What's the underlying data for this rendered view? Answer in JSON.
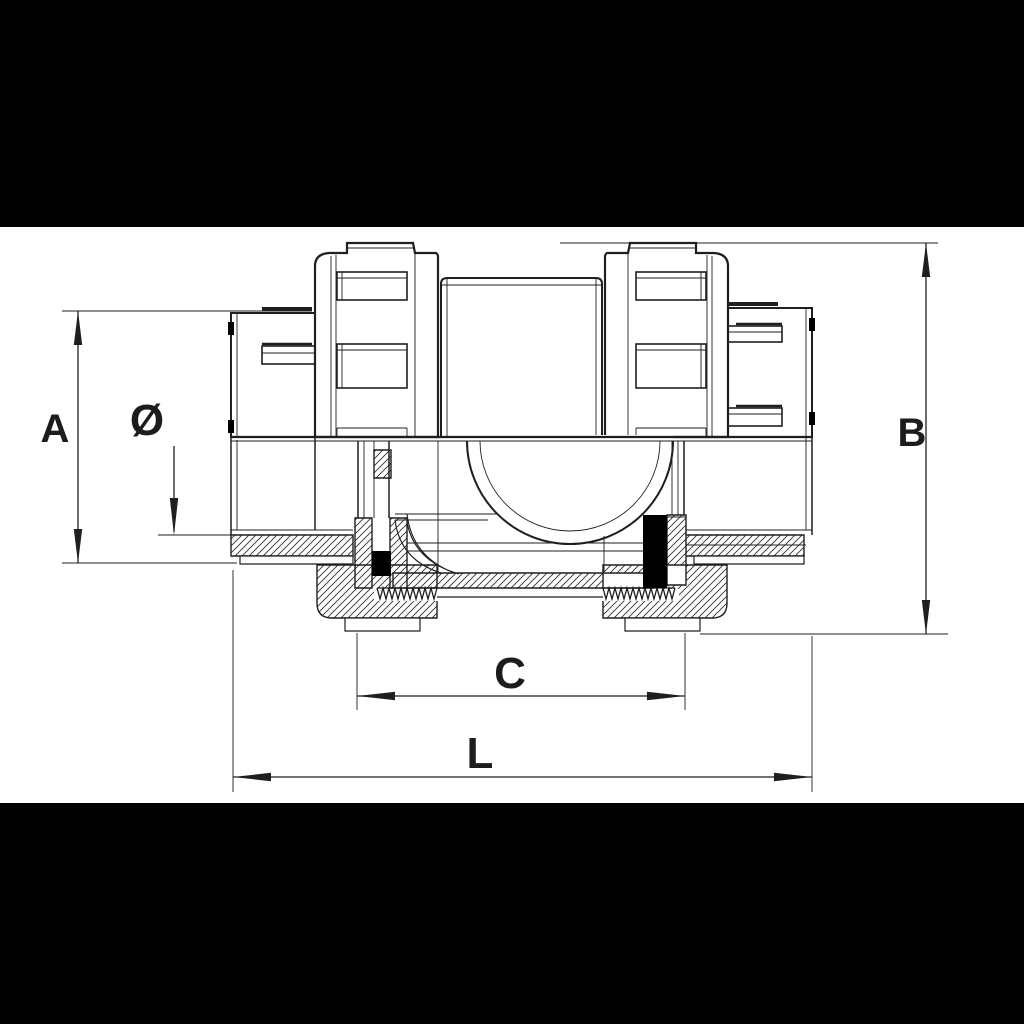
{
  "figure": {
    "kind": "technical dimensional drawing",
    "colors": {
      "background": "#ffffff",
      "letterbox": "#000000",
      "line": "#1f1f1f",
      "seal": "#000000"
    }
  },
  "labels": {
    "dim_a": "A",
    "dim_diameter": "Ø",
    "dim_b": "B",
    "dim_c": "C",
    "dim_l": "L"
  }
}
